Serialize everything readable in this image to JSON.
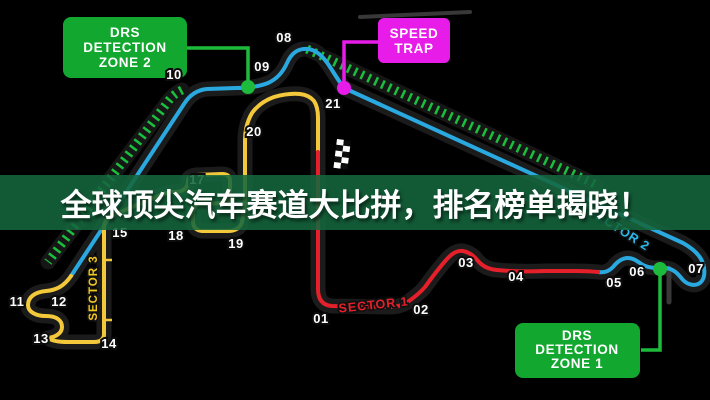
{
  "banner": {
    "text": "全球顶尖汽车赛道大比拼，排名榜单揭晓！",
    "bg_color": "#14673e",
    "text_color": "#ffffff"
  },
  "callouts": {
    "drs_zone_2": {
      "lines": [
        "DRS",
        "DETECTION",
        "ZONE 2"
      ],
      "color": "#12a72e"
    },
    "speed_trap": {
      "lines": [
        "SPEED",
        "TRAP"
      ],
      "color": "#e81ce8"
    },
    "drs_zone_1": {
      "lines": [
        "DRS",
        "DETECTION",
        "ZONE 1"
      ],
      "color": "#12a72e"
    }
  },
  "sectors": [
    {
      "name": "SECTOR 1",
      "color": "#e5202a"
    },
    {
      "name": "SECTOR 2",
      "color": "#2aa9e0"
    },
    {
      "name": "SECTOR 3",
      "color": "#f2c71f"
    }
  ],
  "colors": {
    "track_sector1": "#e5202a",
    "track_sector2": "#2aa9e0",
    "track_sector3": "#f3c93b",
    "drs_ticks": "#1bbf3e",
    "detection_dot": "#1dbb3c",
    "speed_trap_dot": "#e81ce8",
    "background": "#000000"
  },
  "turns": [
    {
      "n": "01",
      "x": 321,
      "y": 323
    },
    {
      "n": "02",
      "x": 421,
      "y": 314
    },
    {
      "n": "03",
      "x": 466,
      "y": 267
    },
    {
      "n": "04",
      "x": 516,
      "y": 281
    },
    {
      "n": "05",
      "x": 614,
      "y": 287
    },
    {
      "n": "06",
      "x": 637,
      "y": 276
    },
    {
      "n": "07",
      "x": 696,
      "y": 273
    },
    {
      "n": "08",
      "x": 284,
      "y": 42
    },
    {
      "n": "09",
      "x": 262,
      "y": 71
    },
    {
      "n": "10",
      "x": 174,
      "y": 79
    },
    {
      "n": "11",
      "x": 17,
      "y": 306
    },
    {
      "n": "12",
      "x": 59,
      "y": 306
    },
    {
      "n": "13",
      "x": 41,
      "y": 343
    },
    {
      "n": "14",
      "x": 109,
      "y": 348
    },
    {
      "n": "15",
      "x": 120,
      "y": 237
    },
    {
      "n": "17",
      "x": 197,
      "y": 184
    },
    {
      "n": "18",
      "x": 176,
      "y": 240
    },
    {
      "n": "19",
      "x": 236,
      "y": 248
    },
    {
      "n": "20",
      "x": 254,
      "y": 136
    },
    {
      "n": "21",
      "x": 333,
      "y": 108
    }
  ]
}
